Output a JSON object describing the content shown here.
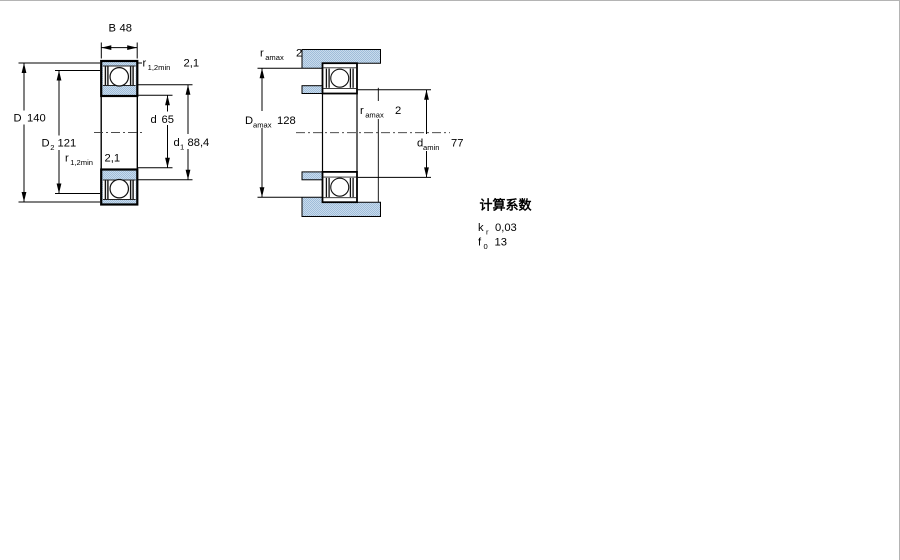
{
  "figure": {
    "type": "bearing-dimension-drawing",
    "colors": {
      "hatch_light": "#c9dbec",
      "hatch_dark": "#9fbdda",
      "line": "#000000"
    },
    "cross_section": {
      "B": {
        "symbol": "B",
        "value": "48"
      },
      "r12min_top": {
        "symbol": "r",
        "subscript": "1,2min",
        "value": "2,1"
      },
      "D": {
        "symbol": "D",
        "value": "140"
      },
      "D2": {
        "symbol": "D",
        "subscript": "2",
        "value": "121"
      },
      "r12min_bottom": {
        "symbol": "r",
        "subscript": "1,2min",
        "value": "2,1"
      },
      "d": {
        "symbol": "d",
        "value": "65"
      },
      "d1": {
        "symbol": "d",
        "subscript": "1",
        "value": "88,4"
      }
    },
    "abutment": {
      "ra_top": {
        "symbol": "r",
        "subscript": "amax",
        "value": "2"
      },
      "Damax": {
        "symbol": "D",
        "subscript": "amax",
        "value": "128"
      },
      "ra_mid": {
        "symbol": "r",
        "subscript": "amax",
        "value": "2"
      },
      "damin": {
        "symbol": "d",
        "subscript": "amin",
        "value": "77"
      }
    },
    "calculation_factors": {
      "heading": "计算系数",
      "kr": {
        "symbol": "k",
        "subscript": "r",
        "value": "0,03"
      },
      "f0": {
        "symbol": "f",
        "subscript": "0",
        "value": "13"
      }
    }
  }
}
